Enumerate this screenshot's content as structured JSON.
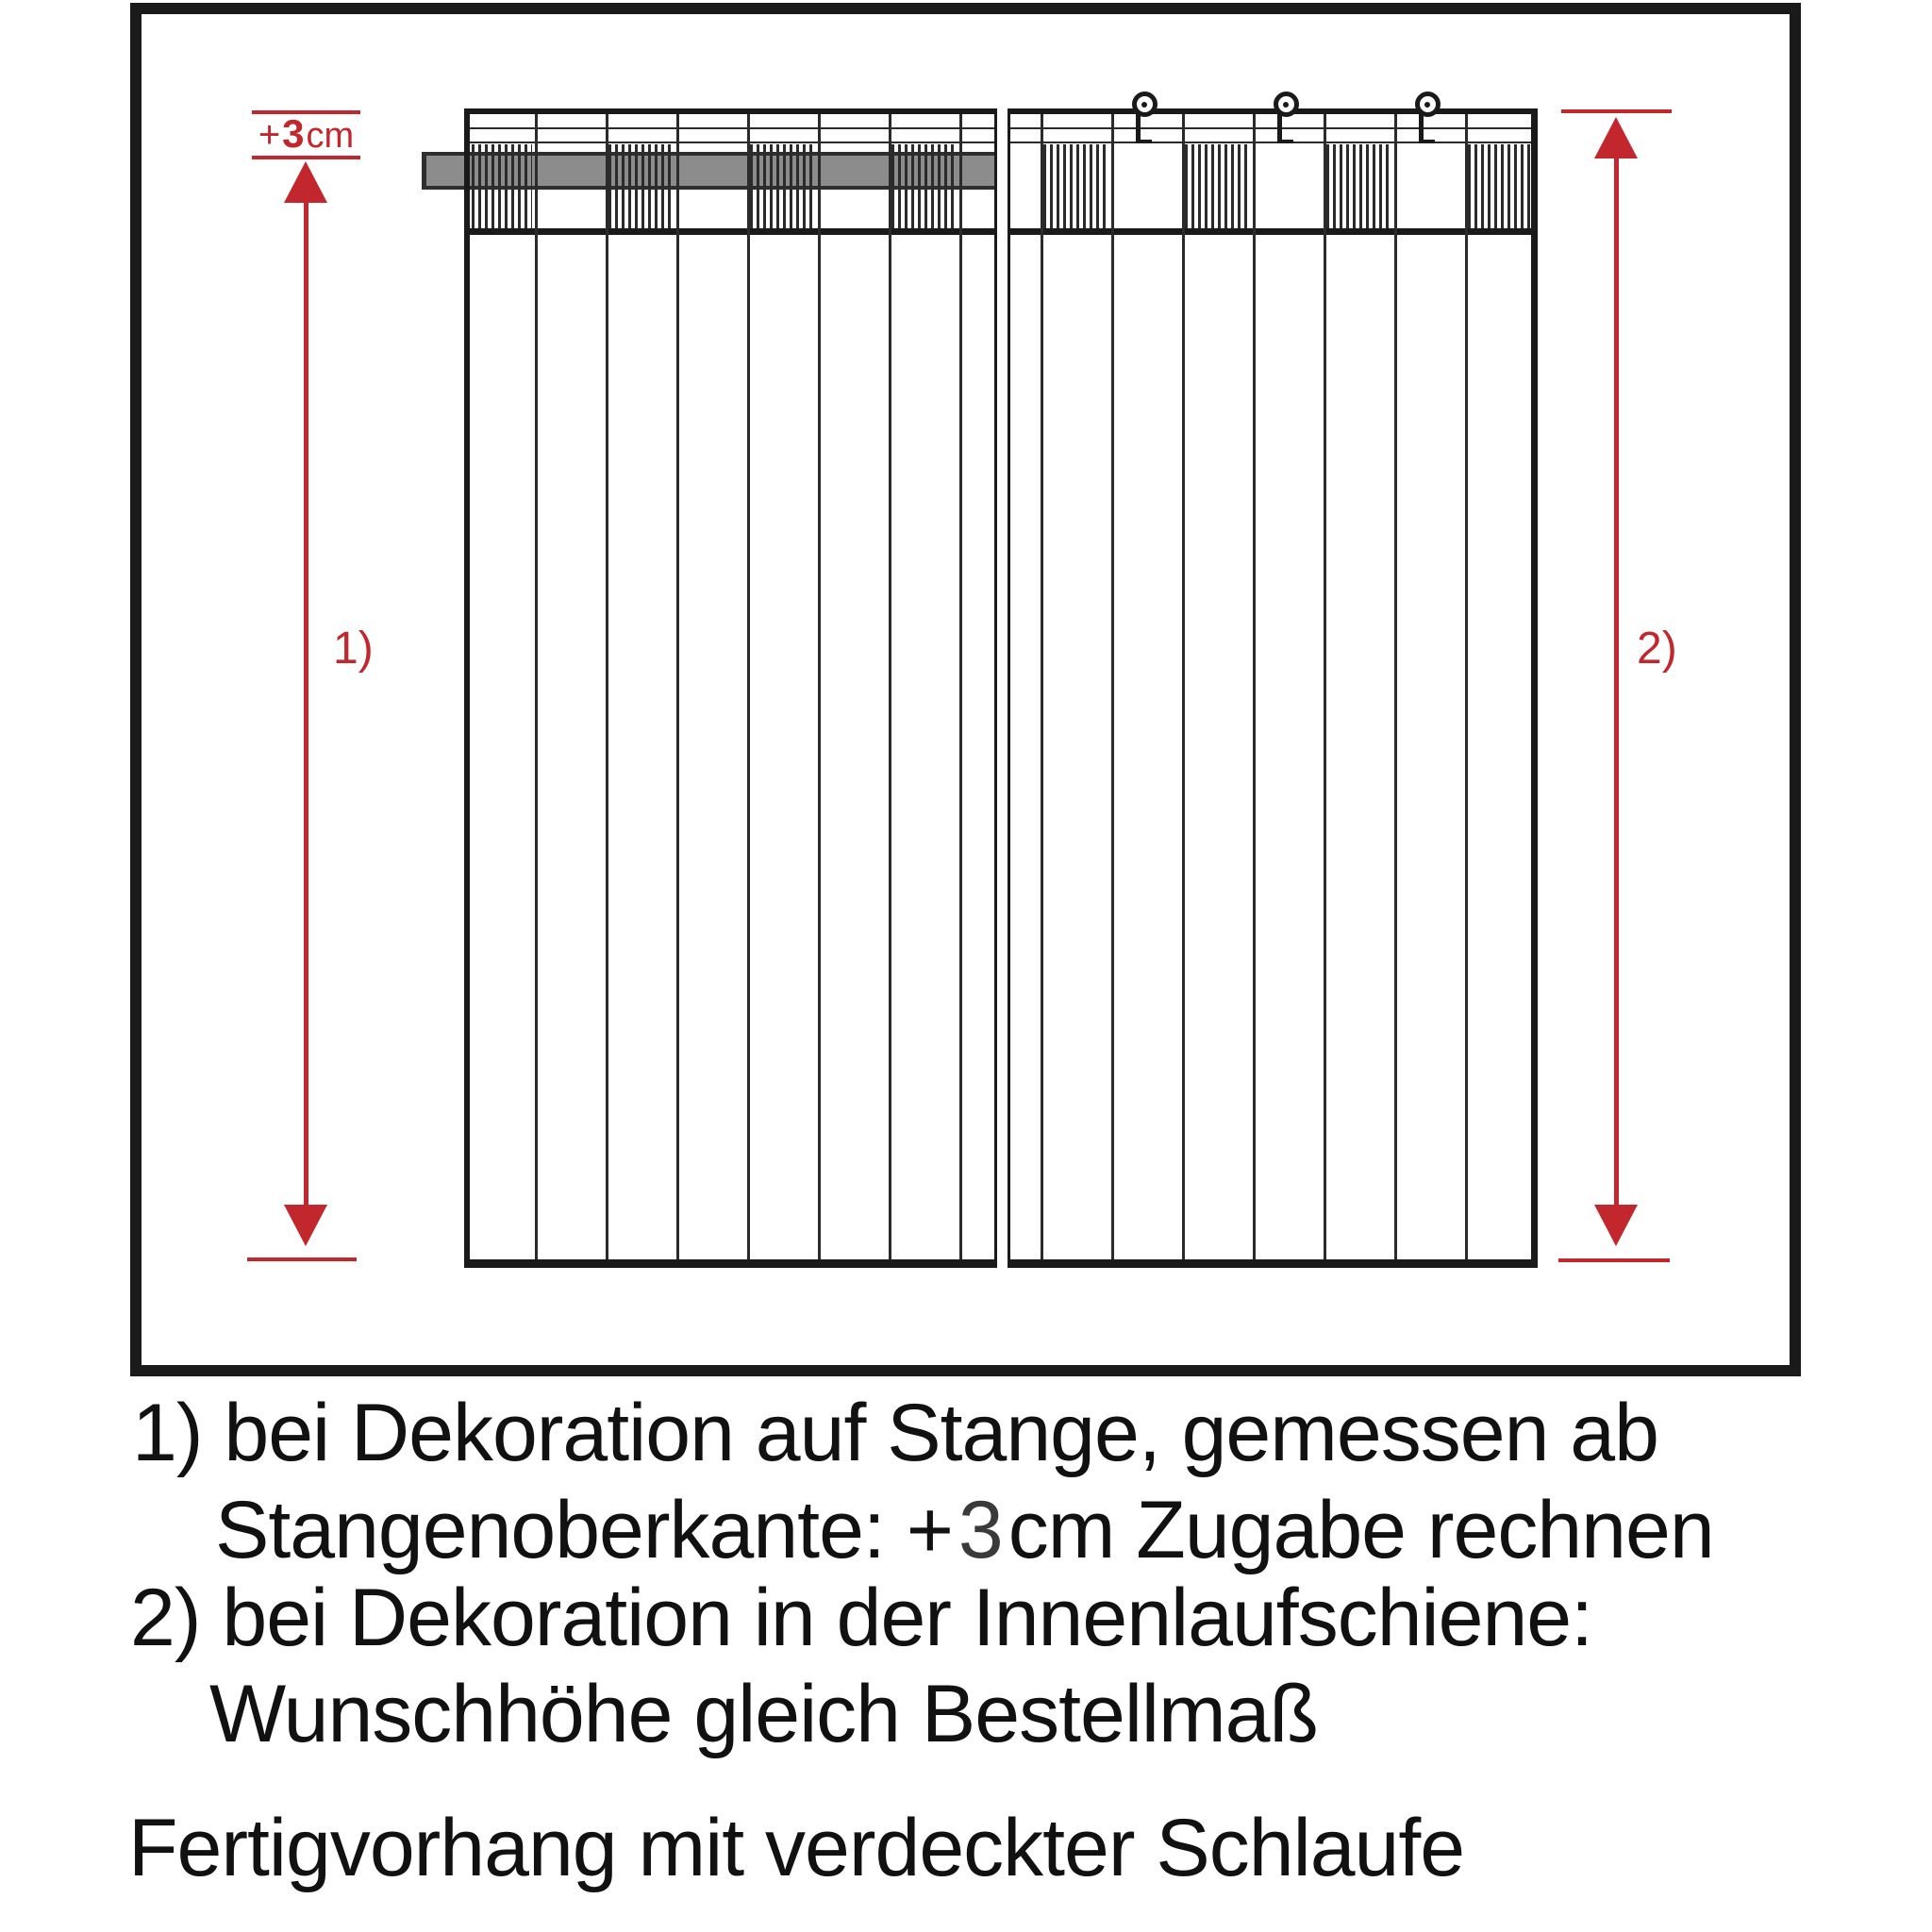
{
  "diagram": {
    "allowance_label": {
      "plus": "+",
      "value": "3",
      "unit": "cm"
    },
    "arrow1_label": "1)",
    "arrow2_label": "2)"
  },
  "notes": {
    "line1": "1) bei Dekoration auf Stange, gemessen ab",
    "line2_prefix": "Stangenoberkante: +",
    "line2_value": "3",
    "line2_suffix": "cm Zugabe rechnen",
    "line3": "2) bei Dekoration in der Innenlaufschiene:",
    "line4": "Wunschhöhe gleich Bestellmaß",
    "line5": "Fertigvorhang mit verdeckter Schlaufe"
  },
  "colors": {
    "accent_red": "#c1272d",
    "line_black": "#1a1a1a",
    "rod_gray": "#8c8c8c"
  }
}
